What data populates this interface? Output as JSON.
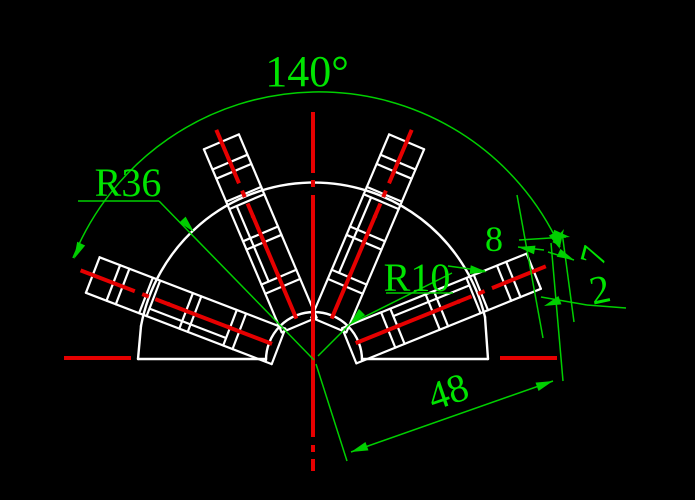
{
  "drawing": {
    "title": "fan-ratchet technical drawing",
    "angle_label": "140°",
    "radius_large_label": "R36",
    "radius_small_label": "R10",
    "rib_width_label": "8",
    "seven_label": "7",
    "two_label": "2",
    "length_label": "48"
  },
  "colors": {
    "background": "#000000",
    "geometry_white": "#ffffff",
    "centerline_red": "#e60000",
    "dimension_green": "#00cf00",
    "dimension_text_green": "#00e400"
  }
}
